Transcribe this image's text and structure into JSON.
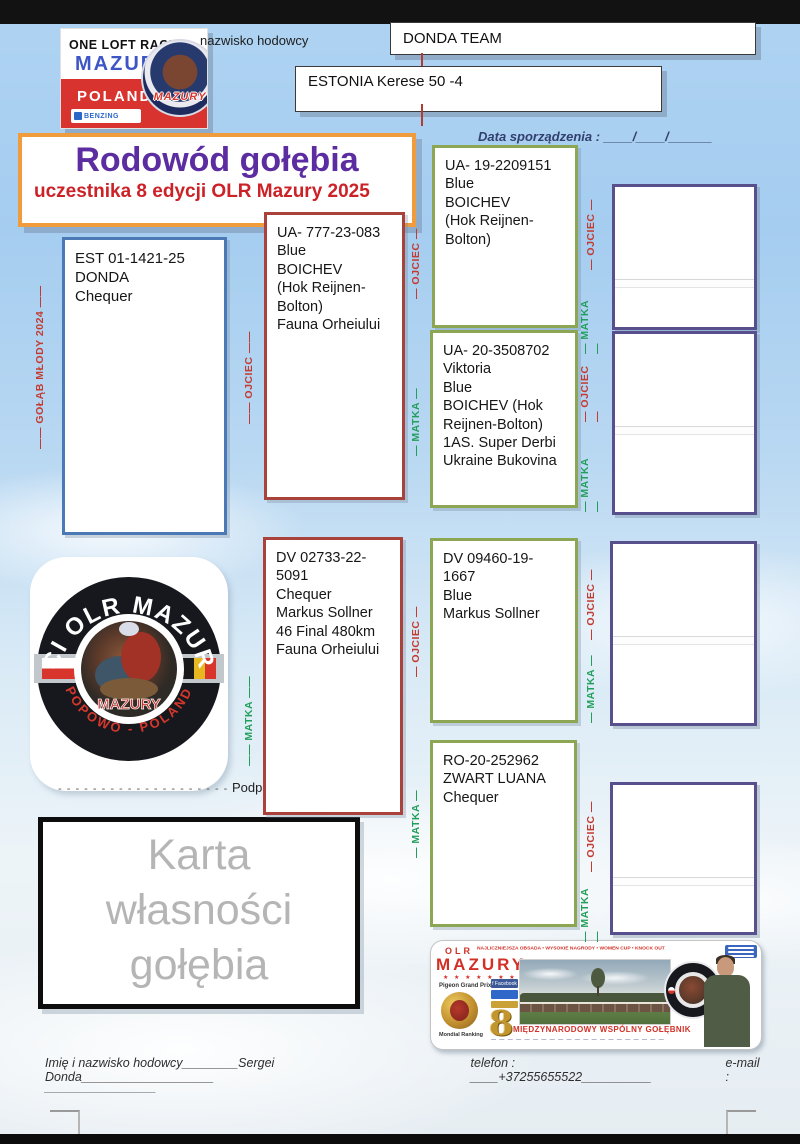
{
  "header": {
    "breeder_label": "nazwisko hodowcy",
    "team": "DONDA TEAM",
    "loft": "ESTONIA Kerese 50 -4",
    "date_line": "Data sporządzenia : ____/____/______"
  },
  "logo": {
    "line1": "ONE LOFT RACE",
    "line2": "MAZURY",
    "line3": "POLAND",
    "benzing": "BENZING",
    "badge": "MAZURY"
  },
  "title": {
    "main": "Rodowód gołębia",
    "sub": "uczestnika 8 edycji OLR Mazury 2025"
  },
  "labels": {
    "young_bird": "—— GOŁĄB MŁODY 2024 ——",
    "father": "—— OJCIEC ——",
    "mother": "—— MATKA ——",
    "father_s": "— OJCIEC —",
    "mother_s": "— MATKA —"
  },
  "pedigree": {
    "subject": "EST 01-1421-25\nDONDA\nChequer",
    "father": "UA- 777-23-083\nBlue\nBOICHEV\n(Hok Reijnen-\nBolton)\nFauna Orheiului",
    "mother": "DV 02733-22-5091\nChequer\nMarkus Sollner\n46 Final 480km\nFauna Orheiului",
    "ff": "UA- 19-2209151\nBlue\nBOICHEV\n(Hok Reijnen-\nBolton)",
    "fm": "UA- 20-3508702\nViktoria\nBlue\nBOICHEV (Hok\nReijnen-Bolton)\n1AS. Super Derbi\nUkraine Bukovina",
    "mf": "DV 09460-19-1667\nBlue\nMarkus Sollner",
    "mm": "RO-20-252962\nZWART LUANA\nChequer"
  },
  "fci_logo": {
    "arc_top": "FCI OLR MAZURY",
    "arc_bottom": "POPOWO - POLAND",
    "center": "MAZURY"
  },
  "signature": {
    "dots": "- - - - - - - - - - - - - - - - - - - -",
    "label": "Podpis"
  },
  "ownership_card": "Karta\nwłasności\ngołębia",
  "banner": {
    "olr": "OLR",
    "mazury": "MAZURY",
    "stars": "★ ★ ★ ★ ★ ★ ★ ★",
    "top_line": "NAJLICZNIEJSZA OBSADA • WYSOKIE NAGRODY • WOMEN CUP • KNOCK OUT • RYWALIZACJA FCI",
    "grand_prix": "Pigeon Grand Prix",
    "facebook": "f Facebook",
    "mondial": "Mondial Ranking",
    "eight": "8",
    "main_line": "MIĘDZYNARODOWY WSPÓLNY GOŁĘBNIK",
    "micro_line": "— — — — —   — — — — — —   — — — — —   — — — — —"
  },
  "footer": {
    "name_line": "Imię i nazwisko hodowcy________Sergei Donda___________________",
    "phone_line": "telefon : ____+37255655522__________",
    "email_line": "e-mail :",
    "line2": "________________"
  },
  "colors": {
    "father_red": "#c43a30",
    "mother_green": "#219e5a",
    "accent_orange": "#f09c3c",
    "title_purple": "#5c2da0"
  }
}
